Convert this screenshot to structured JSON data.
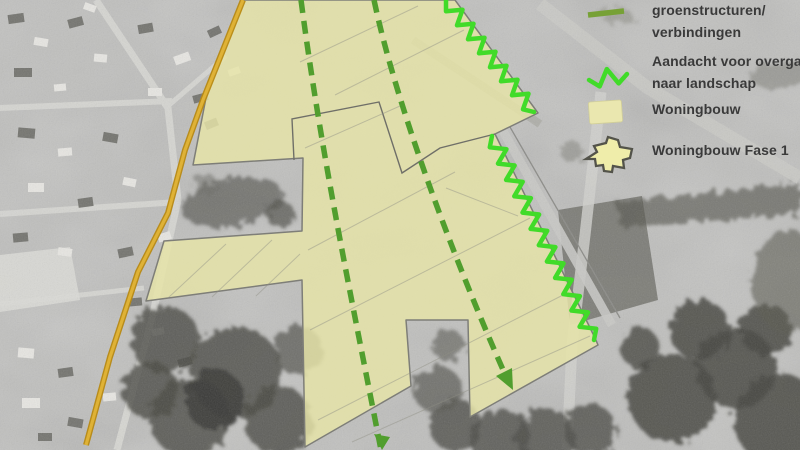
{
  "legend": {
    "items": [
      {
        "icon": "green-dash-line-icon",
        "line1": "groenstructuren/",
        "line2": "verbindingen"
      },
      {
        "icon": "green-zigzag-line-icon",
        "line1": "Aandacht voor overga",
        "line2": "naar landschap"
      },
      {
        "icon": "housing-area-swatch-icon",
        "line1": "Woningbouw"
      },
      {
        "icon": "housing-phase1-swatch-icon",
        "line1": "Woningbouw Fase 1"
      }
    ]
  },
  "map": {
    "overlay_colors": {
      "housing_fill": "#e6e3a7",
      "dashed_green": "#4f9f2b",
      "zigzag_green": "#3edc25",
      "road_gold": "#d2a31d",
      "outline_gray": "#7e7e78",
      "legend_dash_olive": "#76a233"
    }
  }
}
